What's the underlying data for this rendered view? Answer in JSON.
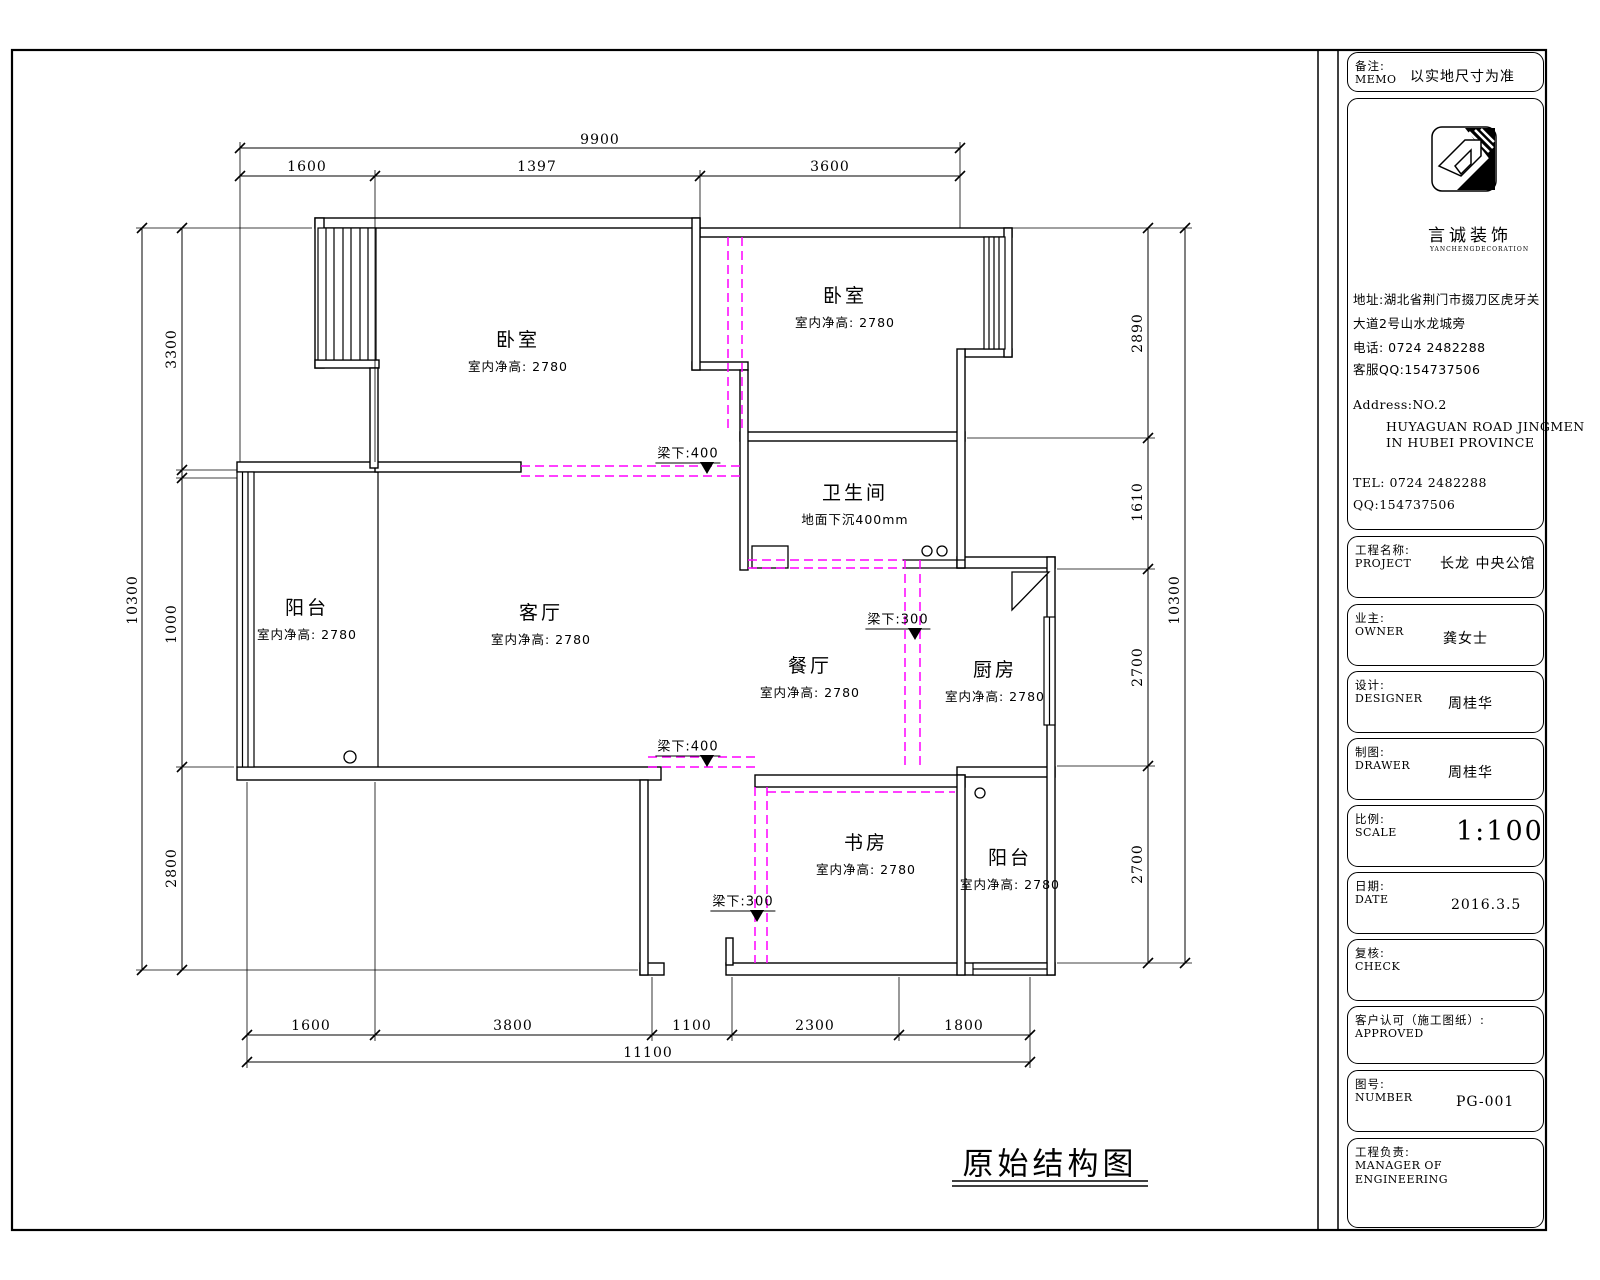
{
  "drawing_title": "原始结构图",
  "colors": {
    "line": "#000000",
    "beam_dashed": "#ff00ff",
    "paper": "#ffffff"
  },
  "plan": {
    "rooms": [
      {
        "id": "bedroom-left",
        "name": "卧室",
        "note": "室内净高: 2780"
      },
      {
        "id": "bedroom-right",
        "name": "卧室",
        "note": "室内净高: 2780"
      },
      {
        "id": "bathroom",
        "name": "卫生间",
        "note": "地面下沉400mm"
      },
      {
        "id": "balcony-left",
        "name": "阳台",
        "note": "室内净高: 2780"
      },
      {
        "id": "living-room",
        "name": "客厅",
        "note": "室内净高: 2780"
      },
      {
        "id": "dining-room",
        "name": "餐厅",
        "note": "室内净高: 2780"
      },
      {
        "id": "kitchen",
        "name": "厨房",
        "note": "室内净高: 2780"
      },
      {
        "id": "study",
        "name": "书房",
        "note": "室内净高: 2780"
      },
      {
        "id": "balcony-bottom",
        "name": "阳台",
        "note": "室内净高: 2780"
      }
    ],
    "beams": [
      "梁下:400",
      "梁下:300",
      "梁下:400",
      "梁下:300"
    ],
    "dims": {
      "top": {
        "total": "9900",
        "chain": [
          "1600",
          "1397",
          "3600"
        ]
      },
      "bottom": {
        "total": "11100",
        "chain": [
          "1600",
          "3800",
          "1100",
          "2300",
          "1800"
        ]
      },
      "left": {
        "total": "10300",
        "chain": [
          "3300",
          "1000",
          "2800"
        ]
      },
      "right": {
        "total": "10300",
        "chain": [
          "2890",
          "1610",
          "2700",
          "2700"
        ]
      }
    }
  },
  "titleblock": {
    "memo": {
      "cn": "备注:",
      "en": "MEMO",
      "value": "以实地尺寸为准"
    },
    "company": {
      "name": "言诚装饰",
      "name_en": "YANCHENGDECORATION",
      "addr1": "地址:湖北省荆门市掇刀区虎牙关",
      "addr2": "大道2号山水龙城旁",
      "phone": "电话: 0724 2482288",
      "qq": "客服QQ:154737506",
      "addr_en1": "Address:NO.2",
      "addr_en2": "HUYAGUAN ROAD JINGMEN",
      "addr_en3": "IN HUBEI PROVINCE",
      "tel_en": "TEL: 0724 2482288",
      "qq_en": "QQ:154737506"
    },
    "project": {
      "cn": "工程名称:",
      "en": "PROJECT",
      "value": "长龙 中央公馆"
    },
    "owner": {
      "cn": "业主:",
      "en": "OWNER",
      "value": "龚女士"
    },
    "designer": {
      "cn": "设计:",
      "en": "DESIGNER",
      "value": "周桂华"
    },
    "drawer": {
      "cn": "制图:",
      "en": "DRAWER",
      "value": "周桂华"
    },
    "scale": {
      "cn": "比例:",
      "en": "SCALE",
      "value": "1:100"
    },
    "date": {
      "cn": "日期:",
      "en": "DATE",
      "value": "2016.3.5"
    },
    "check": {
      "cn": "复核:",
      "en": "CHECK",
      "value": ""
    },
    "approved": {
      "cn": "客户认可（施工图纸）:",
      "en": "APPROVED",
      "value": ""
    },
    "number": {
      "cn": "图号:",
      "en": "NUMBER",
      "value": "PG-001"
    },
    "manager": {
      "cn": "工程负责:",
      "en1": "MANAGER OF",
      "en2": "ENGINEERING"
    }
  }
}
